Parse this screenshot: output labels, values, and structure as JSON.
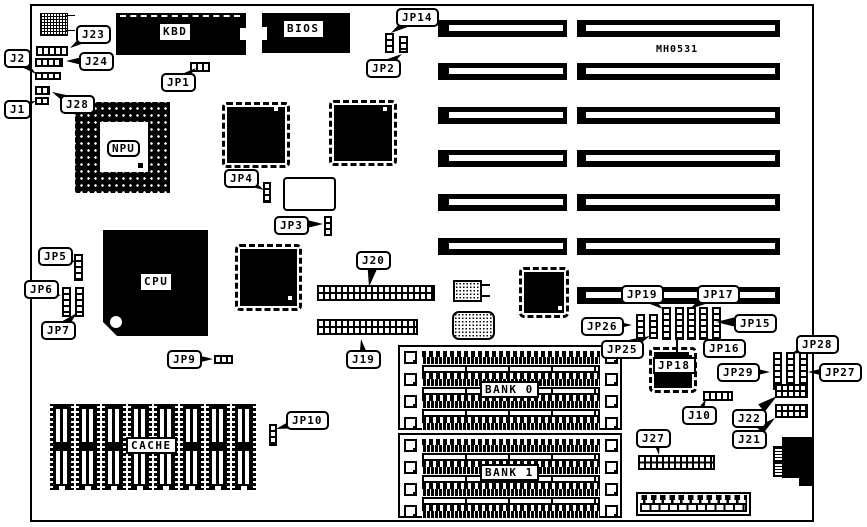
{
  "board": {
    "part_number": "MH0531",
    "chip_labels": {
      "kbd": "KBD",
      "bios": "BIOS",
      "npu": "NPU",
      "cpu": "CPU",
      "cache": "CACHE",
      "bank0": "BANK 0",
      "bank1": "BANK 1"
    },
    "callouts": {
      "j1": "J1",
      "j2": "J2",
      "j23": "J23",
      "j24": "J24",
      "j28": "J28",
      "jp1": "JP1",
      "jp14": "JP14",
      "jp2": "JP2",
      "jp4": "JP4",
      "jp3": "JP3",
      "jp5": "JP5",
      "jp6": "JP6",
      "jp7": "JP7",
      "jp9": "JP9",
      "jp10": "JP10",
      "j20": "J20",
      "j19": "J19",
      "jp19": "JP19",
      "jp17": "JP17",
      "jp26": "JP26",
      "jp25": "JP25",
      "jp15": "JP15",
      "jp16": "JP16",
      "jp18": "JP18",
      "jp29": "JP29",
      "jp28": "JP28",
      "jp27": "JP27",
      "j10": "J10",
      "j22": "J22",
      "j21": "J21",
      "j27": "J27"
    }
  }
}
